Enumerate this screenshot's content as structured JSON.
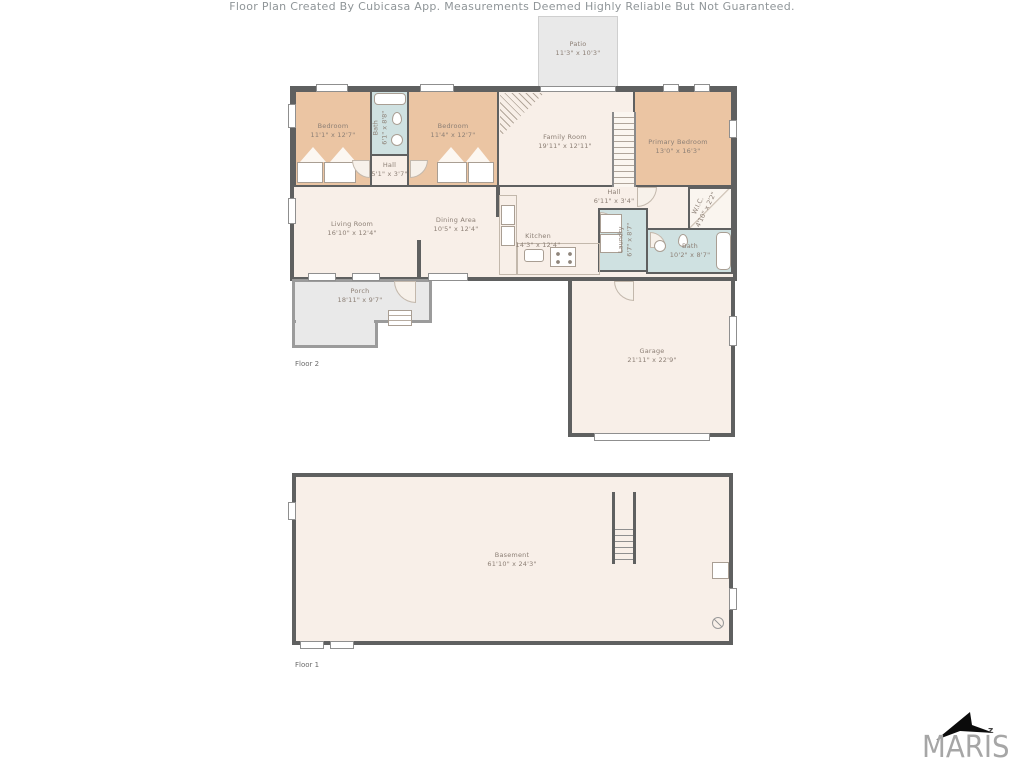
{
  "colors": {
    "wall": "#5f6060",
    "floor": "#f8efe8",
    "bedroom": "#ebc5a3",
    "bath": "#cfe1e1",
    "outdoor": "#e9e9e9",
    "label_text": "#8c7f75",
    "disclaimer_text": "#8f9598",
    "logo_gray": "#a6a6a6"
  },
  "floor2": {
    "label": "Floor 2",
    "rooms": [
      {
        "name": "Patio",
        "dims": "11'3\" x 10'3\""
      },
      {
        "name": "Bedroom",
        "dims": "11'1\" x 12'7\""
      },
      {
        "name": "Bath",
        "dims": "6'1\" x 8'8\""
      },
      {
        "name": "Hall",
        "dims": "5'1\" x 3'7\""
      },
      {
        "name": "Bedroom",
        "dims": "11'4\" x 12'7\""
      },
      {
        "name": "Family Room",
        "dims": "19'11\" x 12'11\""
      },
      {
        "name": "Primary Bedroom",
        "dims": "13'0\" x 16'3\""
      },
      {
        "name": "Living Room",
        "dims": "16'10\" x 12'4\""
      },
      {
        "name": "Dining Area",
        "dims": "10'5\" x 12'4\""
      },
      {
        "name": "Kitchen",
        "dims": "14'3\" x 12'4\""
      },
      {
        "name": "Hall",
        "dims": "6'11\" x 3'4\""
      },
      {
        "name": "Laundry",
        "dims": "6'7\" x 8'7\""
      },
      {
        "name": "W.I.C.",
        "dims": "4'10\" x 2'2\""
      },
      {
        "name": "Bath",
        "dims": "10'2\" x 8'7\""
      },
      {
        "name": "Porch",
        "dims": "18'11\" x 9'7\""
      },
      {
        "name": "Garage",
        "dims": "21'11\" x 22'9\""
      }
    ]
  },
  "floor1": {
    "label": "Floor 1",
    "rooms": [
      {
        "name": "Basement",
        "dims": "61'10\" x 24'3\""
      }
    ]
  },
  "footer": {
    "disclaimer": "Floor Plan Created By Cubicasa App. Measurements Deemed Highly Reliable But Not Guaranteed.",
    "logo_text": "MARIS",
    "logo_mark": "z"
  }
}
